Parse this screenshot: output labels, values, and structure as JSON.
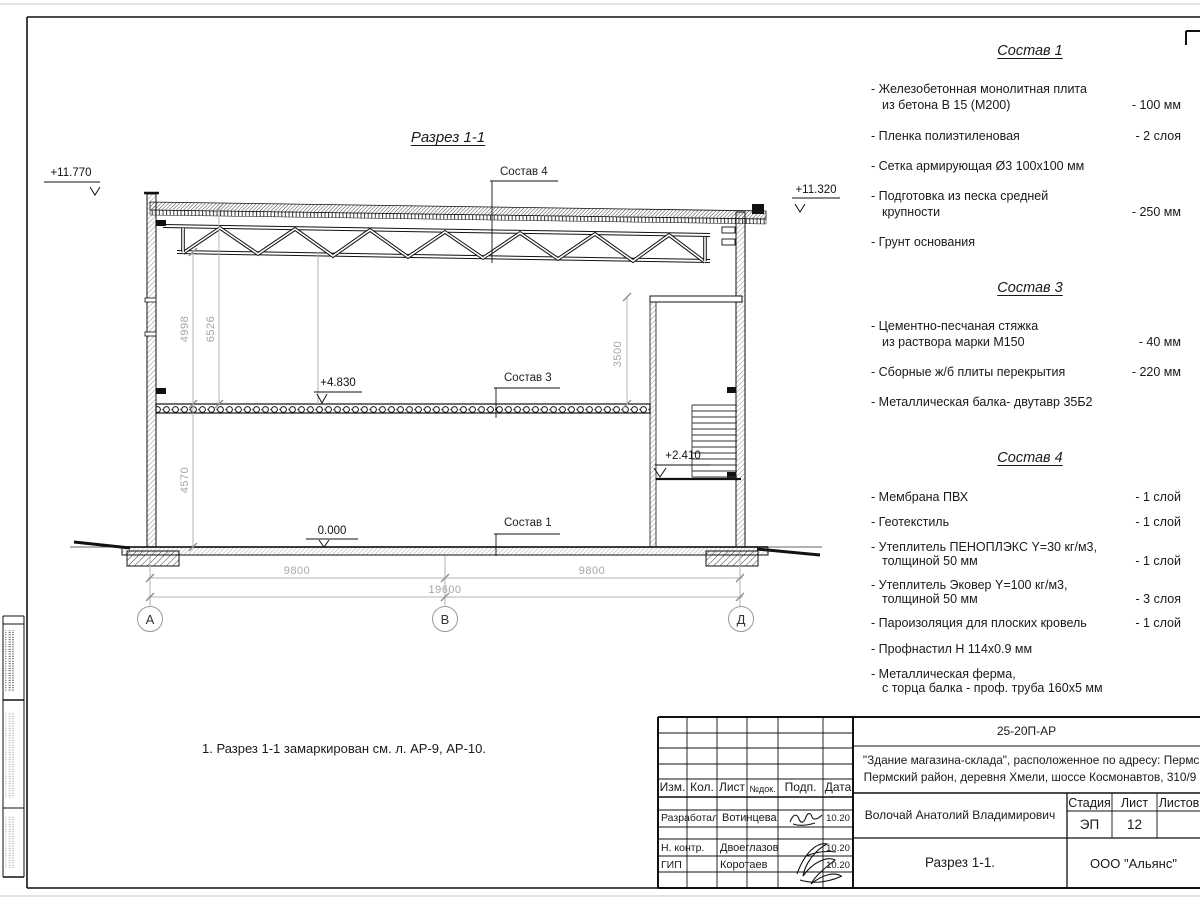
{
  "drawing": {
    "title": "Разрез 1-1",
    "note": "1. Разрез 1-1 замаркирован см. л. АР-9, АР-10.",
    "elevation_marks": {
      "roof_left": "+11.770",
      "roof_right": "+11.320",
      "floor2": "+4.830",
      "landing": "+2.410",
      "ground": "0.000"
    },
    "dims": {
      "v4998": "4998",
      "v6526": "6526",
      "v3500": "3500",
      "v4570": "4570",
      "span_left": "9800",
      "span_right": "9800",
      "span_total": "19600"
    },
    "axes": {
      "left": "А",
      "middle": "В",
      "right": "Д"
    },
    "callouts": {
      "c4": "Состав 4",
      "c3": "Состав 3",
      "c1": "Состав 1"
    }
  },
  "comp1": {
    "title": "Состав 1",
    "items": [
      {
        "l1": "- Железобетонная  монолитная плита",
        "l2": "из бетона В 15 (М200)",
        "v": "- 100 мм"
      },
      {
        "l1": "- Пленка полиэтиленовая",
        "v": "-  2 слоя"
      },
      {
        "l1": "- Сетка армирующая Ø3 100х100 мм",
        "v": ""
      },
      {
        "l1": "- Подготовка из песка средней",
        "l2": "крупности",
        "v": "- 250 мм"
      },
      {
        "l1": "- Грунт основания",
        "v": ""
      }
    ]
  },
  "comp3": {
    "title": "Состав 3",
    "items": [
      {
        "l1": "- Цементно-песчаная стяжка",
        "l2": "из раствора марки М150",
        "v": "- 40 мм"
      },
      {
        "l1": "- Сборные ж/б плиты перекрытия",
        "v": "- 220 мм"
      },
      {
        "l1": "- Металлическая балка- двутавр 35Б2",
        "v": ""
      }
    ]
  },
  "comp4": {
    "title": "Состав 4",
    "items": [
      {
        "l1": "- Мембрана ПВХ",
        "v": "- 1 слой"
      },
      {
        "l1": "- Геотекстиль",
        "v": "- 1 слой"
      },
      {
        "l1": "- Утеплитель ПЕНОПЛЭКС Y=30 кг/м3,",
        "l2": "толщиной 50 мм",
        "v": "- 1 слой"
      },
      {
        "l1": "- Утеплитель Эковер Y=100 кг/м3,",
        "l2": "толщиной 50 мм",
        "v": "- 3 слоя"
      },
      {
        "l1": "- Пароизоляция для плоских кровель",
        "v": "- 1 слой"
      },
      {
        "l1": "- Профнастил Н 114х0.9 мм",
        "v": ""
      },
      {
        "l1": "- Металлическая ферма,",
        "l2": "с торца балка - проф. труба 160х5 мм",
        "v": ""
      }
    ]
  },
  "titleblock": {
    "doc_number": "25-20П-АР",
    "project_line1": "\"Здание магазина-склада\", расположенное по адресу: Пермский край,",
    "project_line2": "Пермский район, деревня Хмели, шоссе Космонавтов, 310/9",
    "author": "Волочай Анатолий Владимирович",
    "sheet_title": "Разрез 1-1.",
    "company": "ООО \"Альянс\"",
    "headers": {
      "izm": "Изм.",
      "kol": "Кол.",
      "list": "Лист",
      "ndok": "№док.",
      "podp": "Подп.",
      "data": "Дата",
      "stage": "Стадия",
      "sheet": "Лист",
      "sheets": "Листов"
    },
    "stage_value": "ЭП",
    "sheet_value": "12",
    "rows": [
      {
        "role": "Разработал",
        "name": "Вотинцева",
        "date": "10.20"
      },
      {
        "role": "Н. контр.",
        "name": "Двоеглазов",
        "date": "10.20"
      },
      {
        "role": "ГИП",
        "name": "Коротаев",
        "date": "10.20"
      }
    ]
  }
}
